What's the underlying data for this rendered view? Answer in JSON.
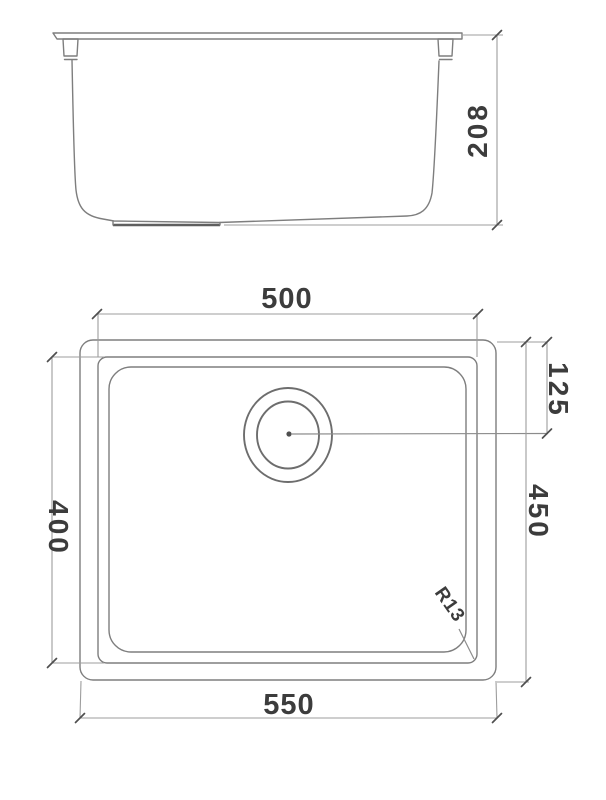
{
  "drawing": {
    "side_view": {
      "height": "208"
    },
    "plan_view": {
      "inner_width": "500",
      "outer_width": "550",
      "inner_depth": "400",
      "outer_depth": "450",
      "drain_offset": "125",
      "corner_radius": "R13"
    },
    "colors": {
      "outline": "#7e7e7e",
      "dimension_line": "#9d9d9d",
      "tick": "#4f4f4f",
      "text": "#3c3c3c",
      "background": "#ffffff"
    }
  }
}
